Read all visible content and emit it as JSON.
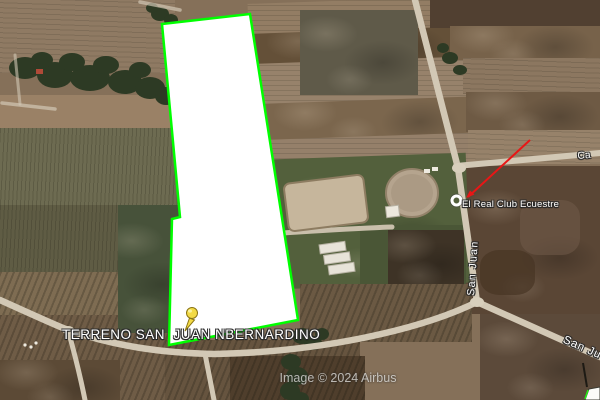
{
  "map": {
    "attribution": "Image © 2024 Airbus",
    "parcel": {
      "label": "TERRENO SAN  JUAN NBERNARDINO",
      "outline_color": "#00ff00",
      "fill_color": "#ffffff"
    },
    "poi": {
      "label": "El Real Club Ecuestre",
      "marker_icon": "white-circle-icon"
    },
    "pushpin": {
      "marker_icon": "yellow-pushpin-icon",
      "color": "#f3da45"
    },
    "annotation": {
      "type": "red-arrow-line",
      "color": "#e81616"
    },
    "roads": {
      "vertical_label": "San Juan",
      "bottom_right_label": "San Ju",
      "top_right_label": "Ca"
    }
  }
}
